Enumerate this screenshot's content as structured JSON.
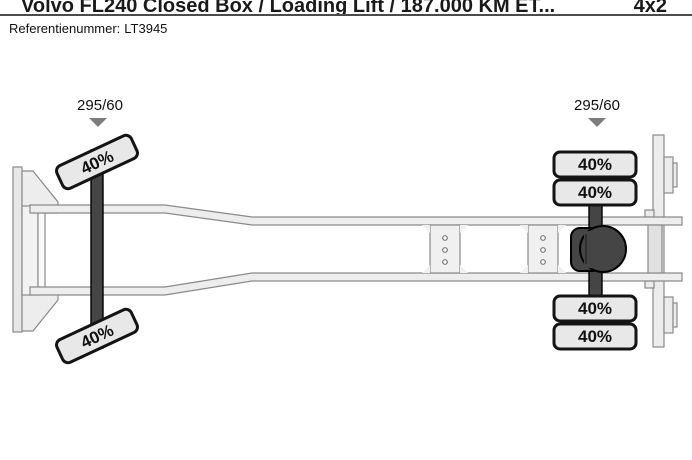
{
  "header": {
    "title": "Volvo FL240 Closed Box / Loading Lift / 187.000 KM ET...",
    "drivetrain": "4x2",
    "reference_label": "Referentienummer:",
    "reference_value": "LT3945"
  },
  "diagram": {
    "view": "truck-chassis-top-view",
    "front_axle": {
      "tire_size": "295/60",
      "tires": [
        {
          "position": "front-left",
          "tread": "40%"
        },
        {
          "position": "front-right",
          "tread": "40%"
        }
      ]
    },
    "rear_axle": {
      "tire_size": "295/60",
      "tires": [
        {
          "position": "rear-left-outer",
          "tread": "40%"
        },
        {
          "position": "rear-left-inner",
          "tread": "40%"
        },
        {
          "position": "rear-right-inner",
          "tread": "40%"
        },
        {
          "position": "rear-right-outer",
          "tread": "40%"
        }
      ]
    }
  },
  "colors": {
    "tire_fill": "#e8e8e8",
    "tire_border": "#141414",
    "axle": "#454545",
    "chassis_fill": "#ededed",
    "chassis_stroke": "#8a8a8a",
    "pointer_marker": "#7d7d7d",
    "separator": "#4b4b4b"
  }
}
